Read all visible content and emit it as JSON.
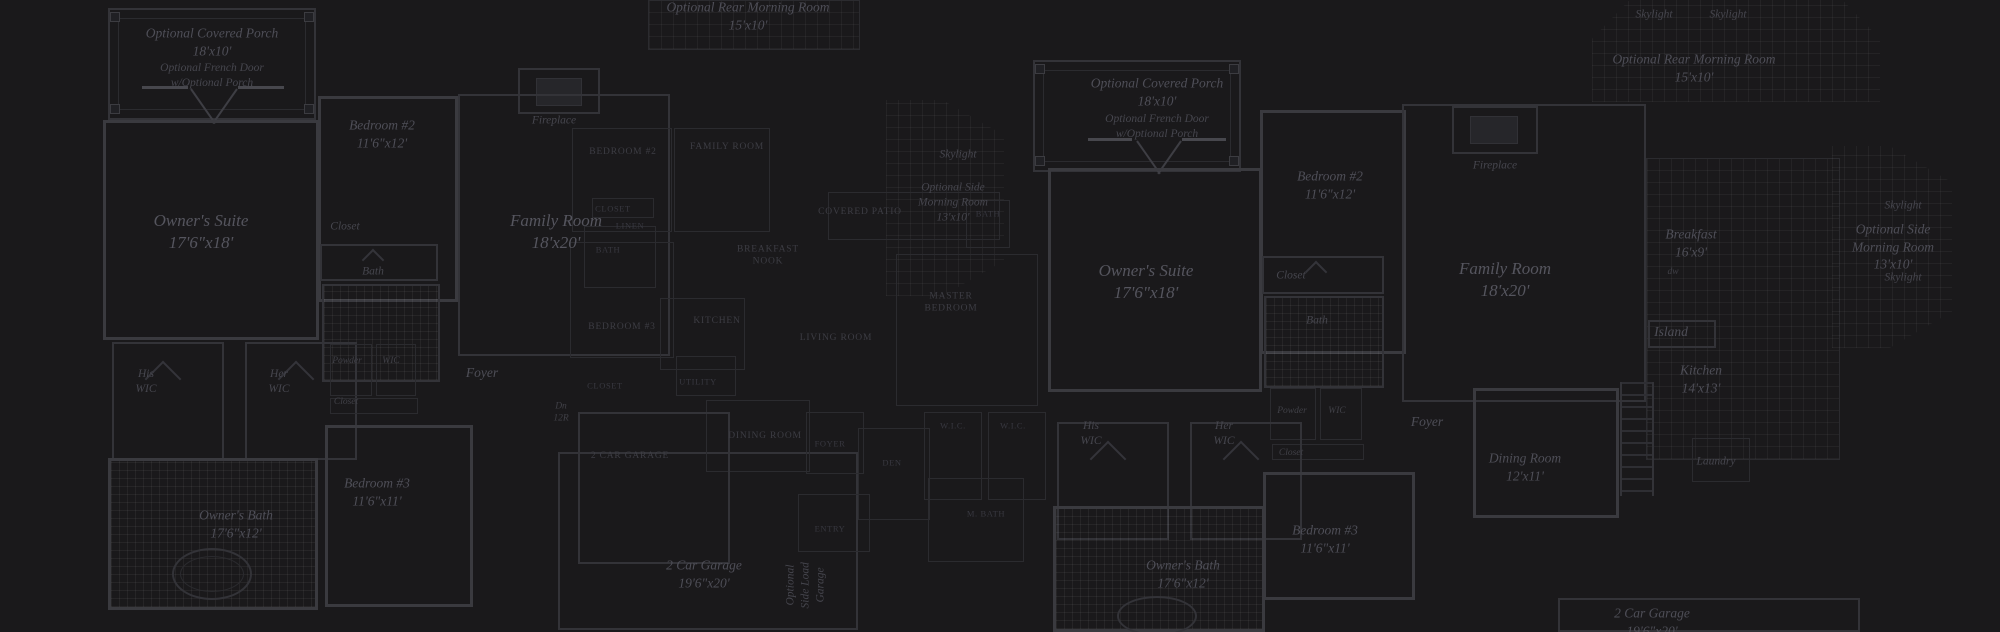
{
  "canvas": {
    "width": 2000,
    "height": 632,
    "background": "#1a191b"
  },
  "palette": {
    "wall_bright": "#3a3a3f",
    "wall": "#333338",
    "wall_dim": "#2b2b2f",
    "text_serif": "#4e4e57",
    "text_caps": "#3d3d44",
    "grid_line": "rgba(255,255,255,0.05)"
  },
  "plans": [
    {
      "id": "left",
      "style": "serif-italic",
      "labels": [
        {
          "id": "covered-porch",
          "text": "Optional Covered Porch\n18'x10'",
          "x": 212,
          "y": 42,
          "cls": "m"
        },
        {
          "id": "french-door",
          "text": "Optional French Door\nw/Optional Porch",
          "x": 212,
          "y": 76,
          "cls": "s"
        },
        {
          "id": "owners-suite",
          "text": "Owner's Suite\n17'6\"x18'",
          "x": 201,
          "y": 232,
          "cls": "l"
        },
        {
          "id": "bedroom2",
          "text": "Bedroom #2\n11'6\"x12'",
          "x": 382,
          "y": 134,
          "cls": "m"
        },
        {
          "id": "closet1",
          "text": "Closet",
          "x": 345,
          "y": 227,
          "cls": "s"
        },
        {
          "id": "bath",
          "text": "Bath",
          "x": 373,
          "y": 272,
          "cls": "s"
        },
        {
          "id": "fireplace",
          "text": "Fireplace",
          "x": 554,
          "y": 121,
          "cls": "s"
        },
        {
          "id": "family-room",
          "text": "Family Room\n18'x20'",
          "x": 556,
          "y": 232,
          "cls": "l"
        },
        {
          "id": "foyer",
          "text": "Foyer",
          "x": 482,
          "y": 373,
          "cls": "m"
        },
        {
          "id": "powder",
          "text": "Powder",
          "x": 347,
          "y": 361,
          "cls": "xs"
        },
        {
          "id": "wic",
          "text": "WIC",
          "x": 391,
          "y": 361,
          "cls": "xs"
        },
        {
          "id": "closet2",
          "text": "Closet",
          "x": 346,
          "y": 402,
          "cls": "xs"
        },
        {
          "id": "his-wic",
          "text": "His\nWIC",
          "x": 146,
          "y": 382,
          "cls": "s"
        },
        {
          "id": "her-wic",
          "text": "Her\nWIC",
          "x": 279,
          "y": 382,
          "cls": "s"
        },
        {
          "id": "bedroom3",
          "text": "Bedroom #3\n11'6\"x11'",
          "x": 377,
          "y": 492,
          "cls": "m"
        },
        {
          "id": "owners-bath",
          "text": "Owner's Bath\n17'6\"x12'",
          "x": 236,
          "y": 524,
          "cls": "m"
        },
        {
          "id": "garage",
          "text": "2 Car Garage\n19'6\"x20'",
          "x": 704,
          "y": 574,
          "cls": "m"
        },
        {
          "id": "side-load-garage",
          "text": "Optional\nSide Load Garage",
          "x": 806,
          "y": 585,
          "cls": "vert"
        },
        {
          "id": "dn-stairs",
          "text": "Dn\n12R",
          "x": 561,
          "y": 413,
          "cls": "xs"
        },
        {
          "id": "rear-morning",
          "text": "Optional Rear Morning Room\n15'x10'",
          "x": 748,
          "y": 16,
          "cls": "m"
        },
        {
          "id": "skylight",
          "text": "Skylight",
          "x": 958,
          "y": 155,
          "cls": "s"
        },
        {
          "id": "side-morning",
          "text": "Optional Side\nMorning Room\n13'x10'",
          "x": 953,
          "y": 203,
          "cls": "s"
        }
      ]
    },
    {
      "id": "middle",
      "style": "caps",
      "labels": [
        {
          "id": "bedroom2",
          "text": "BEDROOM #2",
          "x": 623,
          "y": 152,
          "cls": "caps"
        },
        {
          "id": "family-room",
          "text": "FAMILY ROOM",
          "x": 727,
          "y": 147,
          "cls": "caps"
        },
        {
          "id": "closet",
          "text": "CLOSET",
          "x": 613,
          "y": 209,
          "cls": "capsxs"
        },
        {
          "id": "linen",
          "text": "LINEN",
          "x": 630,
          "y": 226,
          "cls": "capsxs"
        },
        {
          "id": "bath",
          "text": "BATH",
          "x": 608,
          "y": 250,
          "cls": "capsxs"
        },
        {
          "id": "bedroom3",
          "text": "BEDROOM #3",
          "x": 622,
          "y": 327,
          "cls": "caps"
        },
        {
          "id": "breakfast-nook",
          "text": "BREAKFAST\nNOOK",
          "x": 768,
          "y": 256,
          "cls": "caps"
        },
        {
          "id": "kitchen",
          "text": "KITCHEN",
          "x": 717,
          "y": 321,
          "cls": "caps"
        },
        {
          "id": "utility",
          "text": "UTILITY",
          "x": 698,
          "y": 382,
          "cls": "capsxs"
        },
        {
          "id": "closet2",
          "text": "CLOSET",
          "x": 605,
          "y": 386,
          "cls": "capsxs"
        },
        {
          "id": "dining-room",
          "text": "DINING ROOM",
          "x": 765,
          "y": 436,
          "cls": "caps"
        },
        {
          "id": "garage",
          "text": "2 CAR GARAGE",
          "x": 630,
          "y": 456,
          "cls": "caps"
        },
        {
          "id": "foyer",
          "text": "FOYER",
          "x": 830,
          "y": 444,
          "cls": "capsxs"
        },
        {
          "id": "entry",
          "text": "ENTRY",
          "x": 830,
          "y": 529,
          "cls": "capsxs"
        },
        {
          "id": "living-room",
          "text": "LIVING ROOM",
          "x": 836,
          "y": 338,
          "cls": "caps"
        },
        {
          "id": "covered-patio",
          "text": "COVERED PATIO",
          "x": 860,
          "y": 212,
          "cls": "caps"
        },
        {
          "id": "bath2",
          "text": "BATH",
          "x": 988,
          "y": 214,
          "cls": "capsxs"
        },
        {
          "id": "master-bedroom",
          "text": "MASTER\nBEDROOM",
          "x": 951,
          "y": 303,
          "cls": "caps"
        },
        {
          "id": "den",
          "text": "DEN",
          "x": 892,
          "y": 463,
          "cls": "capsxs"
        },
        {
          "id": "wic1",
          "text": "W.I.C.",
          "x": 953,
          "y": 426,
          "cls": "capsxs"
        },
        {
          "id": "wic2",
          "text": "W.I.C.",
          "x": 1013,
          "y": 426,
          "cls": "capsxs"
        },
        {
          "id": "m-bath",
          "text": "M. BATH",
          "x": 986,
          "y": 514,
          "cls": "capsxs"
        }
      ]
    },
    {
      "id": "right",
      "style": "serif-italic",
      "labels": [
        {
          "id": "covered-porch",
          "text": "Optional Covered Porch\n18'x10'",
          "x": 1157,
          "y": 92,
          "cls": "m"
        },
        {
          "id": "french-door",
          "text": "Optional French Door\nw/Optional Porch",
          "x": 1157,
          "y": 127,
          "cls": "s"
        },
        {
          "id": "skylight1",
          "text": "Skylight",
          "x": 1654,
          "y": 15,
          "cls": "s"
        },
        {
          "id": "skylight2",
          "text": "Skylight",
          "x": 1728,
          "y": 15,
          "cls": "s"
        },
        {
          "id": "rear-morning",
          "text": "Optional Rear Morning Room\n15'x10'",
          "x": 1694,
          "y": 68,
          "cls": "m"
        },
        {
          "id": "bedroom2",
          "text": "Bedroom #2\n11'6\"x12'",
          "x": 1330,
          "y": 185,
          "cls": "m"
        },
        {
          "id": "fireplace",
          "text": "Fireplace",
          "x": 1495,
          "y": 166,
          "cls": "s"
        },
        {
          "id": "owners-suite",
          "text": "Owner's Suite\n17'6\"x18'",
          "x": 1146,
          "y": 282,
          "cls": "l"
        },
        {
          "id": "family-room",
          "text": "Family Room\n18'x20'",
          "x": 1505,
          "y": 280,
          "cls": "l"
        },
        {
          "id": "breakfast",
          "text": "Breakfast\n16'x9'",
          "x": 1691,
          "y": 243,
          "cls": "m"
        },
        {
          "id": "dw",
          "text": "dw",
          "x": 1673,
          "y": 272,
          "cls": "xs"
        },
        {
          "id": "island",
          "text": "Island",
          "x": 1671,
          "y": 332,
          "cls": "m"
        },
        {
          "id": "kitchen",
          "text": "Kitchen\n14'x13'",
          "x": 1701,
          "y": 379,
          "cls": "m"
        },
        {
          "id": "skylight3",
          "text": "Skylight",
          "x": 1903,
          "y": 206,
          "cls": "s"
        },
        {
          "id": "side-morning",
          "text": "Optional Side\nMorning Room\n13'x10'",
          "x": 1893,
          "y": 247,
          "cls": "m"
        },
        {
          "id": "skylight4",
          "text": "Skylight",
          "x": 1903,
          "y": 278,
          "cls": "s"
        },
        {
          "id": "closet1",
          "text": "Closet",
          "x": 1291,
          "y": 276,
          "cls": "s"
        },
        {
          "id": "bath",
          "text": "Bath",
          "x": 1317,
          "y": 321,
          "cls": "s"
        },
        {
          "id": "powder",
          "text": "Powder",
          "x": 1292,
          "y": 411,
          "cls": "xs"
        },
        {
          "id": "wic",
          "text": "WIC",
          "x": 1337,
          "y": 411,
          "cls": "xs"
        },
        {
          "id": "closet2",
          "text": "Closet",
          "x": 1291,
          "y": 453,
          "cls": "xs"
        },
        {
          "id": "his-wic",
          "text": "His\nWIC",
          "x": 1091,
          "y": 434,
          "cls": "s"
        },
        {
          "id": "her-wic",
          "text": "Her\nWIC",
          "x": 1224,
          "y": 434,
          "cls": "s"
        },
        {
          "id": "foyer",
          "text": "Foyer",
          "x": 1427,
          "y": 422,
          "cls": "m"
        },
        {
          "id": "dining-room",
          "text": "Dining Room\n12'x11'",
          "x": 1525,
          "y": 467,
          "cls": "m"
        },
        {
          "id": "owners-bath",
          "text": "Owner's Bath\n17'6\"x12'",
          "x": 1183,
          "y": 574,
          "cls": "m"
        },
        {
          "id": "bedroom3",
          "text": "Bedroom #3\n11'6\"x11'",
          "x": 1325,
          "y": 539,
          "cls": "m"
        },
        {
          "id": "garage",
          "text": "2 Car Garage\n19'6\"x20'",
          "x": 1652,
          "y": 622,
          "cls": "m"
        },
        {
          "id": "laundry",
          "text": "Laundry",
          "x": 1716,
          "y": 462,
          "cls": "s"
        }
      ]
    }
  ]
}
